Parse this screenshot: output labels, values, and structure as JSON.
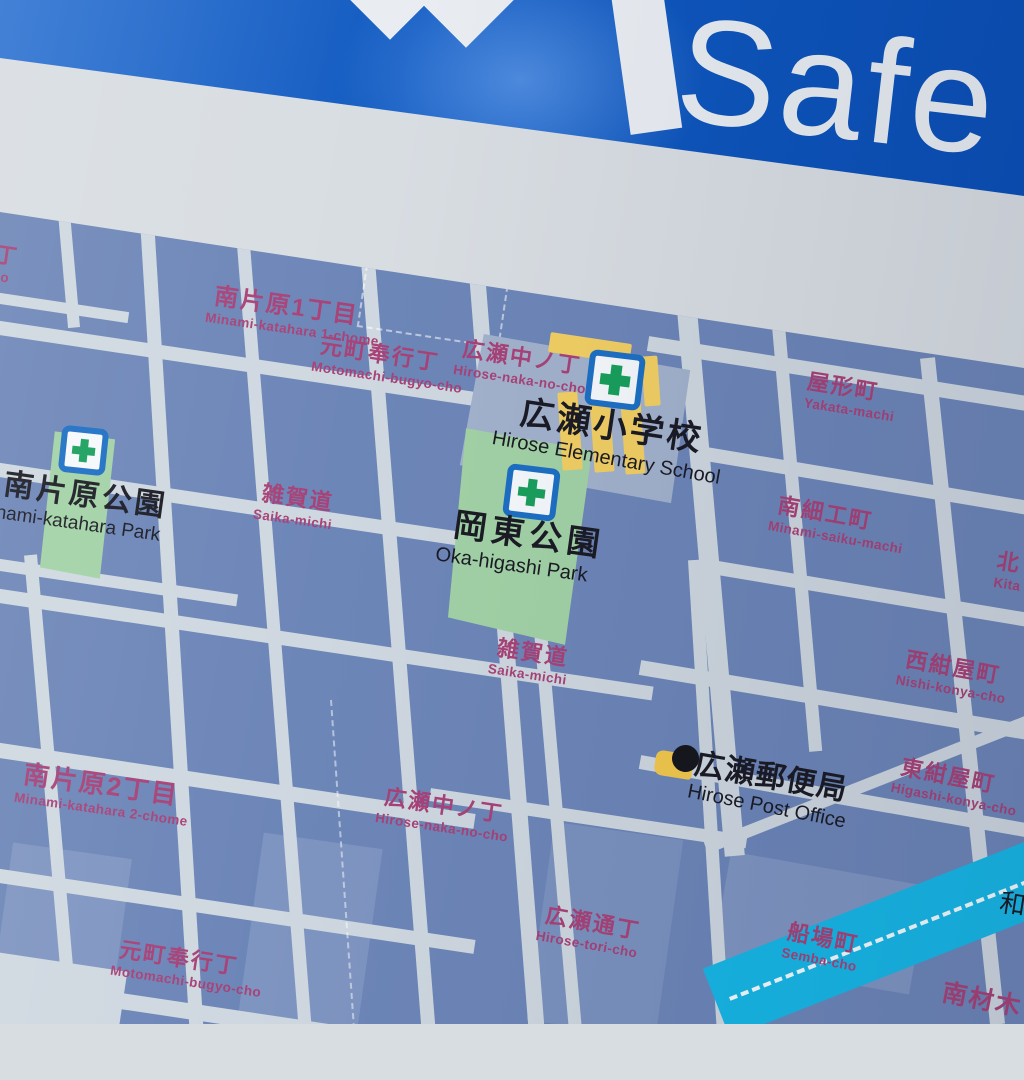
{
  "sign": {
    "banner_text": "Safe",
    "banner_color": "#0f57bf",
    "banner_text_color": "#e7ecf1"
  },
  "map": {
    "colors": {
      "block": "#6d86b8",
      "road": "#cfd8e0",
      "park": "#a3d2a6",
      "school_building": "#f2cf63",
      "river": "#17b7e6",
      "town_label": "#a84277",
      "facility_label": "#1b1b24",
      "evac_icon_border": "#1d6fc4",
      "evac_icon_cross": "#199f5c",
      "post_icon_yellow": "#f2c94c"
    },
    "towns": [
      {
        "kanji": "丁",
        "romaji": "ho"
      },
      {
        "kanji": "南片原1丁目",
        "romaji": "Minami-katahara 1-chome"
      },
      {
        "kanji": "元町奉行丁",
        "romaji": "Motomachi-bugyo-cho"
      },
      {
        "kanji": "広瀬中ノ丁",
        "romaji": "Hirose-naka-no-cho"
      },
      {
        "kanji": "屋形町",
        "romaji": "Yakata-machi"
      },
      {
        "kanji": "雑賀道",
        "romaji": "Saika-michi"
      },
      {
        "kanji": "南細工町",
        "romaji": "Minami-saiku-machi"
      },
      {
        "kanji": "北",
        "romaji": "Kita"
      },
      {
        "kanji": "雑賀道",
        "romaji": "Saika-michi"
      },
      {
        "kanji": "西紺屋町",
        "romaji": "Nishi-konya-cho"
      },
      {
        "kanji": "南片原2丁目",
        "romaji": "Minami-katahara 2-chome"
      },
      {
        "kanji": "広瀬中ノ丁",
        "romaji": "Hirose-naka-no-cho"
      },
      {
        "kanji": "東紺屋町",
        "romaji": "Higashi-konya-cho"
      },
      {
        "kanji": "広瀬通丁",
        "romaji": "Hirose-tori-cho"
      },
      {
        "kanji": "船場町",
        "romaji": "Semba-cho"
      },
      {
        "kanji": "元町奉行丁",
        "romaji": "Motomachi-bugyo-cho"
      },
      {
        "kanji": "南材木",
        "romaji": ""
      }
    ],
    "facilities": [
      {
        "kanji": "広瀬小学校",
        "romaji": "Hirose Elementary School"
      },
      {
        "kanji": "岡東公園",
        "romaji": "Oka-higashi Park"
      },
      {
        "kanji": "南片原公園",
        "romaji": "nami-katahara Park"
      },
      {
        "kanji": "広瀬郵便局",
        "romaji": "Hirose Post Office"
      }
    ],
    "river_label_fragment": "和"
  }
}
